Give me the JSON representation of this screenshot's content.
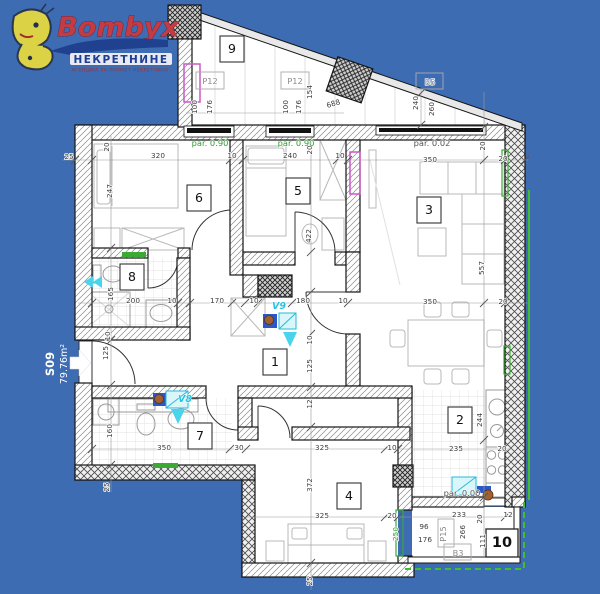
{
  "logo": {
    "brand": "Bombyx",
    "subtitle": "НЕКРЕТНИНЕ",
    "tagline": "АГЕНЦИЈА ЗА ПРОМЕТ НЕКРЕТНИНА"
  },
  "unit": {
    "code": "S09",
    "area": "79.76m²"
  },
  "colors": {
    "background": "#3e6cb3",
    "wall_line": "#151515",
    "green_marker": "#3aaa35",
    "green_outline": "#3fbf2f",
    "magenta_marker": "#c95ac9",
    "cyan_marker": "#25c3e3",
    "logo_red": "#c23c44",
    "logo_navy": "#1d3f93"
  },
  "plan": {
    "rooms": [
      {
        "label": "1",
        "x": 275,
        "y": 366
      },
      {
        "label": "2",
        "x": 460,
        "y": 424
      },
      {
        "label": "3",
        "x": 429,
        "y": 214
      },
      {
        "label": "4",
        "x": 349,
        "y": 500
      },
      {
        "label": "5",
        "x": 298,
        "y": 195
      },
      {
        "label": "6",
        "x": 199,
        "y": 202
      },
      {
        "label": "7",
        "x": 200,
        "y": 440
      },
      {
        "label": "8",
        "x": 132,
        "y": 281
      },
      {
        "label": "9",
        "x": 232,
        "y": 53
      },
      {
        "label": "10",
        "x": 502,
        "y": 547,
        "big": 1
      }
    ],
    "tags": [
      {
        "label": "P12",
        "x": 210,
        "y": 84
      },
      {
        "label": "P12",
        "x": 295,
        "y": 84
      },
      {
        "label": "B5",
        "x": 430,
        "y": 85
      },
      {
        "label": "B3",
        "x": 458,
        "y": 556
      },
      {
        "label": "P15",
        "x": 446,
        "y": 534,
        "r": -90
      }
    ],
    "pars": [
      {
        "label": "par. 0.90",
        "x": 210,
        "y": 146,
        "g": 1
      },
      {
        "label": "par. 0.90",
        "x": 296,
        "y": 146,
        "g": 1
      },
      {
        "label": "par. 0.02",
        "x": 432,
        "y": 146
      },
      {
        "label": "par. 0.00",
        "x": 462,
        "y": 496
      }
    ],
    "vents": [
      {
        "label": "V9",
        "x": 279,
        "y": 309
      },
      {
        "label": "V8",
        "x": 185,
        "y": 402
      }
    ],
    "dims": [
      {
        "t": "100",
        "x": 197,
        "y": 107,
        "r": -90
      },
      {
        "t": "176",
        "x": 212,
        "y": 107,
        "r": -90
      },
      {
        "t": "100",
        "x": 288,
        "y": 107,
        "r": -90
      },
      {
        "t": "176",
        "x": 301,
        "y": 107,
        "r": -90
      },
      {
        "t": "154",
        "x": 312,
        "y": 92,
        "r": -90
      },
      {
        "t": "688",
        "x": 334,
        "y": 106,
        "r": -17
      },
      {
        "t": "240",
        "x": 418,
        "y": 103,
        "r": -90
      },
      {
        "t": "260",
        "x": 434,
        "y": 109,
        "r": -90
      },
      {
        "t": "25",
        "x": 69,
        "y": 159
      },
      {
        "t": "20",
        "x": 109,
        "y": 147,
        "r": -90
      },
      {
        "t": "320",
        "x": 158,
        "y": 158
      },
      {
        "t": "10",
        "x": 232,
        "y": 158
      },
      {
        "t": "240",
        "x": 290,
        "y": 158
      },
      {
        "t": "10",
        "x": 340,
        "y": 158
      },
      {
        "t": "20",
        "x": 312,
        "y": 150,
        "r": -90
      },
      {
        "t": "350",
        "x": 430,
        "y": 162
      },
      {
        "t": "20",
        "x": 503,
        "y": 161
      },
      {
        "t": "20",
        "x": 485,
        "y": 146,
        "r": -90
      },
      {
        "t": "247",
        "x": 112,
        "y": 191,
        "r": -90
      },
      {
        "t": "422",
        "x": 311,
        "y": 236,
        "r": -90
      },
      {
        "t": "557",
        "x": 484,
        "y": 268,
        "r": -90
      },
      {
        "t": "165",
        "x": 113,
        "y": 294,
        "r": -90
      },
      {
        "t": "200",
        "x": 133,
        "y": 303
      },
      {
        "t": "10",
        "x": 172,
        "y": 303
      },
      {
        "t": "170",
        "x": 217,
        "y": 303
      },
      {
        "t": "10",
        "x": 254,
        "y": 303
      },
      {
        "t": "180",
        "x": 303,
        "y": 303
      },
      {
        "t": "10",
        "x": 343,
        "y": 303
      },
      {
        "t": "10",
        "x": 312,
        "y": 340,
        "r": -90
      },
      {
        "t": "125",
        "x": 312,
        "y": 366,
        "r": -90
      },
      {
        "t": "12",
        "x": 312,
        "y": 404,
        "r": -90
      },
      {
        "t": "10",
        "x": 110,
        "y": 336,
        "r": -90
      },
      {
        "t": "125",
        "x": 108,
        "y": 353,
        "r": -90
      },
      {
        "t": "160",
        "x": 112,
        "y": 431,
        "r": -90
      },
      {
        "t": "350",
        "x": 164,
        "y": 450
      },
      {
        "t": "30",
        "x": 239,
        "y": 450
      },
      {
        "t": "325",
        "x": 322,
        "y": 450
      },
      {
        "t": "10",
        "x": 392,
        "y": 450
      },
      {
        "t": "372",
        "x": 312,
        "y": 485,
        "r": -90
      },
      {
        "t": "325",
        "x": 322,
        "y": 518
      },
      {
        "t": "20",
        "x": 392,
        "y": 518
      },
      {
        "t": "25",
        "x": 109,
        "y": 487,
        "r": -90
      },
      {
        "t": "25",
        "x": 312,
        "y": 581,
        "r": -90
      },
      {
        "t": "350",
        "x": 430,
        "y": 304
      },
      {
        "t": "20",
        "x": 503,
        "y": 304
      },
      {
        "t": "244",
        "x": 482,
        "y": 420,
        "r": -90
      },
      {
        "t": "235",
        "x": 456,
        "y": 451
      },
      {
        "t": "20",
        "x": 502,
        "y": 451
      },
      {
        "t": "233",
        "x": 459,
        "y": 517
      },
      {
        "t": "20",
        "x": 482,
        "y": 519,
        "r": -90
      },
      {
        "t": "12",
        "x": 508,
        "y": 517
      },
      {
        "t": "96",
        "x": 424,
        "y": 529
      },
      {
        "t": "176",
        "x": 425,
        "y": 542
      },
      {
        "t": "266",
        "x": 465,
        "y": 532,
        "r": -90
      },
      {
        "t": "111",
        "x": 485,
        "y": 541,
        "r": -90
      },
      {
        "t": "250",
        "x": 398,
        "y": 534,
        "r": -90,
        "g": 1
      }
    ]
  }
}
